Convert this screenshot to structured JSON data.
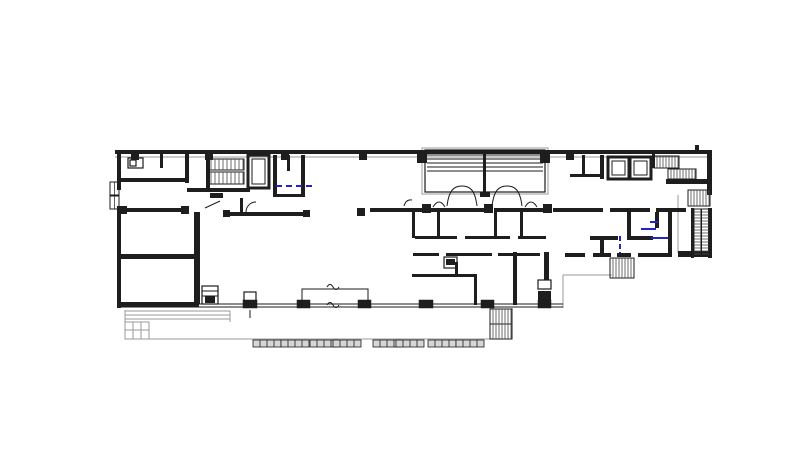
{
  "document": {
    "type": "architectural-floor-plan",
    "title": "",
    "canvas": {
      "width": 807,
      "height": 456
    },
    "colors": {
      "paper": "#ffffff",
      "ink": "#1b1b1b",
      "wall": "#1e1e1e",
      "tread": "#4a4a4a",
      "shadow_gray": "#9a9a9a",
      "paver_fill": "#d6d6d6",
      "accent_blue": "#2323c8"
    }
  },
  "plan": {
    "walls": [
      [
        115,
        150,
        597,
        4
      ],
      [
        117,
        153,
        4,
        37
      ],
      [
        117,
        206,
        4,
        102
      ],
      [
        707,
        151,
        5,
        44
      ],
      [
        695,
        145,
        4,
        6
      ],
      [
        678,
        251,
        34,
        6
      ],
      [
        666,
        179,
        41,
        5
      ],
      [
        121,
        178,
        66,
        4
      ],
      [
        160,
        153,
        3,
        15
      ],
      [
        185,
        153,
        4,
        30
      ],
      [
        206,
        153,
        4,
        35
      ],
      [
        187,
        188,
        63,
        4
      ],
      [
        210,
        193,
        13,
        5
      ],
      [
        273,
        155,
        4,
        42
      ],
      [
        301,
        155,
        4,
        42
      ],
      [
        287,
        155,
        3,
        16
      ],
      [
        273,
        194,
        32,
        3
      ],
      [
        225,
        212,
        82,
        4
      ],
      [
        121,
        208,
        64,
        4
      ],
      [
        194,
        212,
        6,
        92
      ],
      [
        121,
        254,
        75,
        5
      ],
      [
        121,
        302,
        78,
        5
      ],
      [
        240,
        198,
        3,
        14
      ],
      [
        205,
        296,
        10,
        7
      ],
      [
        370,
        208,
        52,
        4
      ],
      [
        430,
        208,
        56,
        4
      ],
      [
        494,
        208,
        52,
        4
      ],
      [
        553,
        208,
        50,
        4
      ],
      [
        610,
        208,
        40,
        4
      ],
      [
        656,
        208,
        30,
        4
      ],
      [
        412,
        212,
        3,
        26
      ],
      [
        437,
        212,
        3,
        24
      ],
      [
        494,
        212,
        3,
        26
      ],
      [
        520,
        212,
        3,
        24
      ],
      [
        415,
        236,
        42,
        3
      ],
      [
        465,
        236,
        45,
        3
      ],
      [
        518,
        236,
        28,
        3
      ],
      [
        413,
        253,
        26,
        3
      ],
      [
        446,
        253,
        46,
        3
      ],
      [
        498,
        253,
        42,
        3
      ],
      [
        446,
        259,
        9,
        6
      ],
      [
        455,
        262,
        3,
        15
      ],
      [
        412,
        274,
        65,
        3
      ],
      [
        474,
        277,
        3,
        28
      ],
      [
        513,
        252,
        4,
        53
      ],
      [
        544,
        252,
        5,
        28
      ],
      [
        538,
        291,
        13,
        17
      ],
      [
        582,
        155,
        3,
        20
      ],
      [
        570,
        174,
        32,
        3
      ],
      [
        600,
        155,
        4,
        24
      ],
      [
        627,
        212,
        4,
        28
      ],
      [
        590,
        236,
        28,
        4
      ],
      [
        627,
        236,
        26,
        4
      ],
      [
        600,
        240,
        4,
        13
      ],
      [
        565,
        253,
        20,
        4
      ],
      [
        593,
        253,
        18,
        4
      ],
      [
        617,
        253,
        14,
        4
      ],
      [
        638,
        253,
        33,
        4
      ],
      [
        668,
        208,
        4,
        49
      ],
      [
        655,
        212,
        4,
        16
      ],
      [
        691,
        208,
        3,
        50
      ],
      [
        708,
        208,
        4,
        50
      ],
      [
        652,
        154,
        3,
        14
      ],
      [
        483,
        150,
        3,
        26
      ],
      [
        483,
        176,
        3,
        18
      ],
      [
        480,
        192,
        10,
        5
      ],
      [
        417,
        150,
        10,
        13
      ],
      [
        540,
        150,
        10,
        13
      ]
    ],
    "thin_lines": [
      [
        121,
        304,
        563,
        304
      ],
      [
        121,
        307,
        563,
        307
      ],
      [
        427,
        155,
        543,
        155
      ],
      [
        427,
        159,
        543,
        159
      ],
      [
        427,
        163,
        543,
        163
      ],
      [
        427,
        167,
        543,
        167
      ],
      [
        427,
        171,
        543,
        171
      ],
      [
        207,
        170,
        244,
        170
      ],
      [
        205,
        208,
        220,
        201
      ],
      [
        490,
        324,
        512,
        324
      ],
      [
        701,
        209,
        701,
        255
      ],
      [
        250,
        310,
        250,
        318
      ],
      [
        202,
        291,
        218,
        291
      ],
      [
        202,
        296,
        218,
        296
      ]
    ],
    "gray_lines": [
      [
        115,
        157,
        712,
        157
      ],
      [
        125,
        310,
        125,
        339
      ],
      [
        125,
        339,
        490,
        339
      ],
      [
        512,
        308,
        512,
        339
      ],
      [
        125,
        311,
        230,
        311
      ],
      [
        125,
        315,
        230,
        315
      ],
      [
        125,
        319,
        230,
        319
      ],
      [
        230,
        311,
        230,
        322
      ],
      [
        133,
        322,
        133,
        339
      ],
      [
        141,
        322,
        141,
        339
      ],
      [
        149,
        322,
        149,
        339
      ],
      [
        125,
        330,
        149,
        330
      ],
      [
        563,
        275,
        563,
        308
      ],
      [
        563,
        275,
        612,
        275
      ],
      [
        678,
        195,
        678,
        253
      ]
    ],
    "gray_outlines": [
      [
        422,
        148,
        126,
        46
      ],
      [
        125,
        322,
        24,
        17
      ]
    ],
    "outlines": [
      [
        425,
        150,
        120,
        42
      ],
      [
        128,
        158,
        15,
        10
      ],
      [
        130,
        160,
        6,
        6
      ],
      [
        202,
        286,
        16,
        18
      ],
      [
        444,
        257,
        13,
        11
      ],
      [
        538,
        280,
        13,
        9
      ],
      [
        244,
        292,
        12,
        9
      ]
    ],
    "columns": [
      [
        131,
        152,
        8
      ],
      [
        205,
        152,
        8
      ],
      [
        281,
        152,
        8
      ],
      [
        359,
        152,
        8
      ],
      [
        566,
        152,
        8
      ],
      [
        119,
        206,
        8
      ],
      [
        181,
        206,
        8
      ],
      [
        223,
        210,
        7
      ],
      [
        303,
        210,
        7
      ],
      [
        357,
        208,
        8
      ],
      [
        422,
        204,
        9
      ],
      [
        484,
        204,
        9
      ],
      [
        543,
        204,
        9
      ]
    ],
    "col_bases": [
      [
        243,
        300,
        14,
        8
      ],
      [
        297,
        300,
        13,
        8
      ],
      [
        358,
        300,
        13,
        8
      ],
      [
        419,
        300,
        14,
        8
      ],
      [
        481,
        300,
        13,
        8
      ],
      [
        538,
        300,
        13,
        8
      ]
    ],
    "stairs": [
      {
        "x": 207,
        "y": 159,
        "w": 37,
        "h": 11,
        "dir": "h",
        "step": 4,
        "name": "stair-run-northwest-upper"
      },
      {
        "x": 207,
        "y": 172,
        "w": 37,
        "h": 12,
        "dir": "h",
        "step": 4,
        "name": "stair-run-northwest-lower"
      },
      {
        "x": 654,
        "y": 156,
        "w": 25,
        "h": 12,
        "dir": "h",
        "step": 3,
        "name": "stair-run-northeast-upper"
      },
      {
        "x": 668,
        "y": 169,
        "w": 28,
        "h": 10,
        "dir": "h",
        "step": 3,
        "name": "stair-run-northeast-mid"
      },
      {
        "x": 688,
        "y": 190,
        "w": 22,
        "h": 16,
        "dir": "h",
        "step": 3,
        "name": "stair-run-east"
      },
      {
        "x": 694,
        "y": 209,
        "w": 15,
        "h": 46,
        "dir": "v",
        "step": 3,
        "mid": true,
        "name": "escalator-east"
      },
      {
        "x": 490,
        "y": 309,
        "w": 22,
        "h": 30,
        "dir": "h",
        "step": 3,
        "name": "exterior-stair-south-center"
      },
      {
        "x": 610,
        "y": 258,
        "w": 24,
        "h": 20,
        "dir": "h",
        "step": 3,
        "name": "exterior-stair-south-east"
      }
    ],
    "elevators": [
      {
        "x": 248,
        "y": 155,
        "w": 21,
        "h": 33
      },
      {
        "x": 608,
        "y": 157,
        "w": 21,
        "h": 22
      },
      {
        "x": 630,
        "y": 157,
        "w": 21,
        "h": 22
      }
    ],
    "windows": [
      [
        110,
        182,
        9,
        13
      ],
      [
        110,
        196,
        9,
        13
      ]
    ],
    "arcs": [
      "M447,206 C449,190 454,186 462,186 C470,186 475,190 477,206",
      "M492,206 C494,190 499,186 507,186 C515,186 520,190 522,206",
      "M433,207 Q439,197 445,207",
      "M525,207 Q531,197 537,207",
      "M246,212 A10,10 0 0 1 256,202",
      "M404,206 Q406,199 412,200",
      "M302,308 L302,289 L368,289 L368,308",
      "M327,287 q3,-5 6,0 q3,5 6,0",
      "M327,305 q3,-5 6,0 q3,5 6,0"
    ],
    "blue_marks": [
      {
        "x1": 276,
        "y1": 186,
        "x2": 314,
        "y2": 186,
        "dash": "6 4"
      },
      {
        "x1": 620,
        "y1": 236,
        "x2": 620,
        "y2": 253,
        "dash": "5 3"
      },
      {
        "x1": 641,
        "y1": 229,
        "x2": 656,
        "y2": 229,
        "dash": ""
      },
      {
        "x1": 651,
        "y1": 238,
        "x2": 668,
        "y2": 238,
        "dash": ""
      },
      {
        "x1": 650,
        "y1": 222,
        "x2": 658,
        "y2": 222,
        "dash": ""
      }
    ],
    "paver_groups": [
      [
        253,
        340
      ],
      [
        281,
        340
      ],
      [
        310,
        340
      ],
      [
        333,
        340
      ],
      [
        373,
        340
      ],
      [
        396,
        340
      ],
      [
        428,
        340
      ],
      [
        456,
        340
      ]
    ],
    "paver_size": {
      "w": 28,
      "h": 7,
      "cells": 4
    }
  }
}
